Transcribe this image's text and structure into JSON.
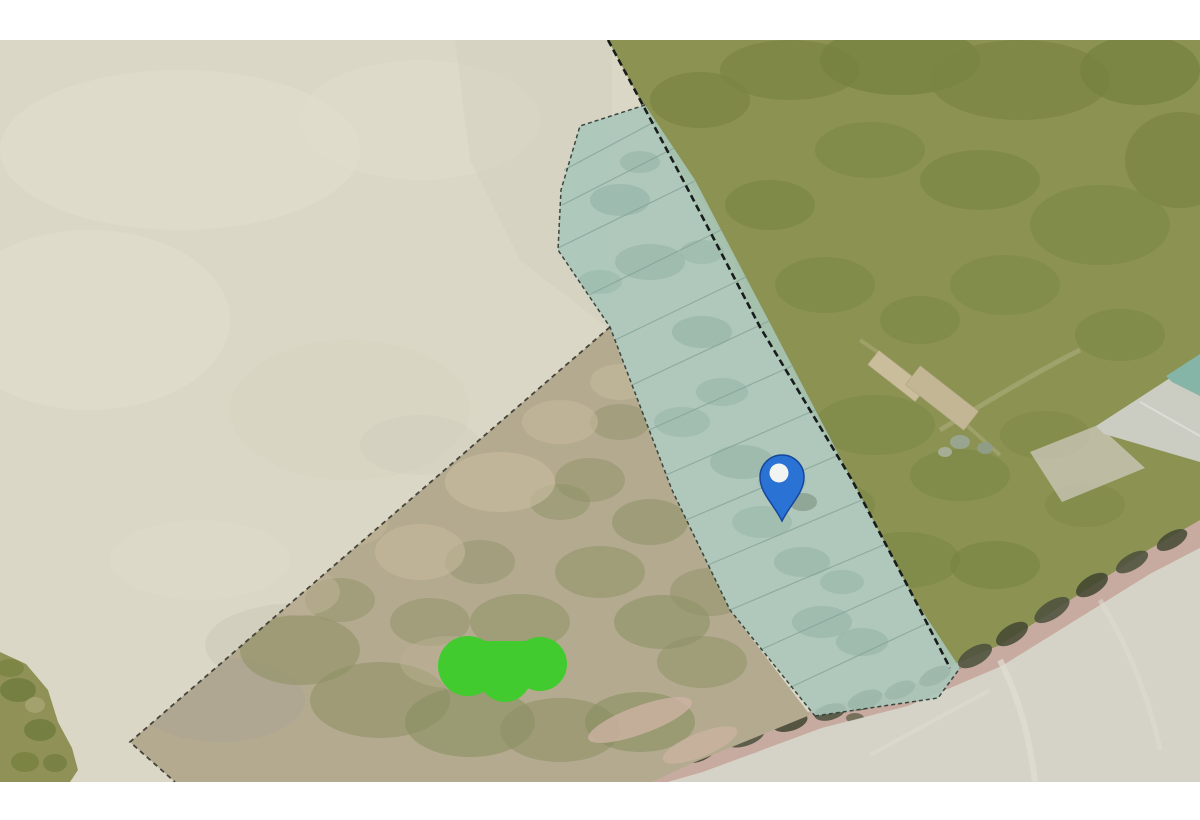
{
  "app": {
    "type": "aerial-map-viewer",
    "description": "Aerial/satellite parcel map screenshot: highlighted teal strip of subdivided lots with a blue location pin, scrub parcel outlined with dashed boundary, grass paddock, farm track road, and a bright green redaction blob. No visible text labels."
  },
  "canvas": {
    "width": 1200,
    "height": 820,
    "map_top": 40,
    "map_bottom": 782,
    "frame_color": "#ffffff"
  },
  "palette": {
    "open_field": "#dbd7c6",
    "open_field_light": "#e4e0d0",
    "open_field_dark": "#cfcbba",
    "parcel_scrub": "#b4aa90",
    "parcel_scrub_olive": "#8f9166",
    "parcel_scrub_sand": "#c4b99c",
    "grass": "#8b9252",
    "grass_dark": "#7a8543",
    "grass_track": "#b5b183",
    "lot_overlay": "#a9c6ba",
    "lot_overlay_dark": "#93b3a6",
    "lot_line": "#84a296",
    "boundary_dark": "#181d1c",
    "parcel_outline": "#45443a",
    "road": "#c7aba1",
    "road_vegetation": "#4a4f3c",
    "flat_gray": "#d5d3c7",
    "roof_gray": "#cbcdc3",
    "roof_teal": "#84b5a6",
    "shed_tan": "#cabd9c",
    "green_patch": "#8f9157",
    "redaction_green": "#41cb2f",
    "pin_blue": "#2a72d4",
    "pin_blue_dark": "#17479c",
    "pin_center_white": "#f2f4f1"
  },
  "marker": {
    "name": "location-pin",
    "x": 782,
    "head_center_y": 477,
    "tip_y": 521,
    "head_radius": 22
  },
  "lot_strip": {
    "name": "highlighted-lot-strip",
    "lot_count": 13,
    "lot_lines": [
      [
        564,
        170,
        656,
        121
      ],
      [
        562,
        205,
        674,
        148
      ],
      [
        558,
        248,
        695,
        181
      ],
      [
        589,
        295,
        721,
        230
      ],
      [
        615,
        340,
        746,
        277
      ],
      [
        632,
        385,
        769,
        321
      ],
      [
        649,
        430,
        792,
        366
      ],
      [
        666,
        475,
        815,
        410
      ],
      [
        686,
        520,
        839,
        455
      ],
      [
        708,
        565,
        862,
        500
      ],
      [
        730,
        610,
        886,
        544
      ],
      [
        760,
        650,
        907,
        584
      ],
      [
        789,
        688,
        930,
        622
      ]
    ]
  },
  "regions": {
    "open_field": "pale open field (left)",
    "scrub_parcel": "dash-outlined scrub/brush parcel (bottom centre)",
    "lot_strip": "teal highlighted strip of narrow subdivided lots",
    "grass_paddock": "green grass paddock (upper right)",
    "farm_buildings": "long tan sheds and grey-roofed building (right)",
    "road": "tree-lined farm road (bottom right)",
    "flat_gray_area": "flat light-grey yard below road",
    "green_patch_corner": "small green vegetation patch (bottom left)",
    "redaction_blob": "bright green redaction blob over parcel"
  }
}
